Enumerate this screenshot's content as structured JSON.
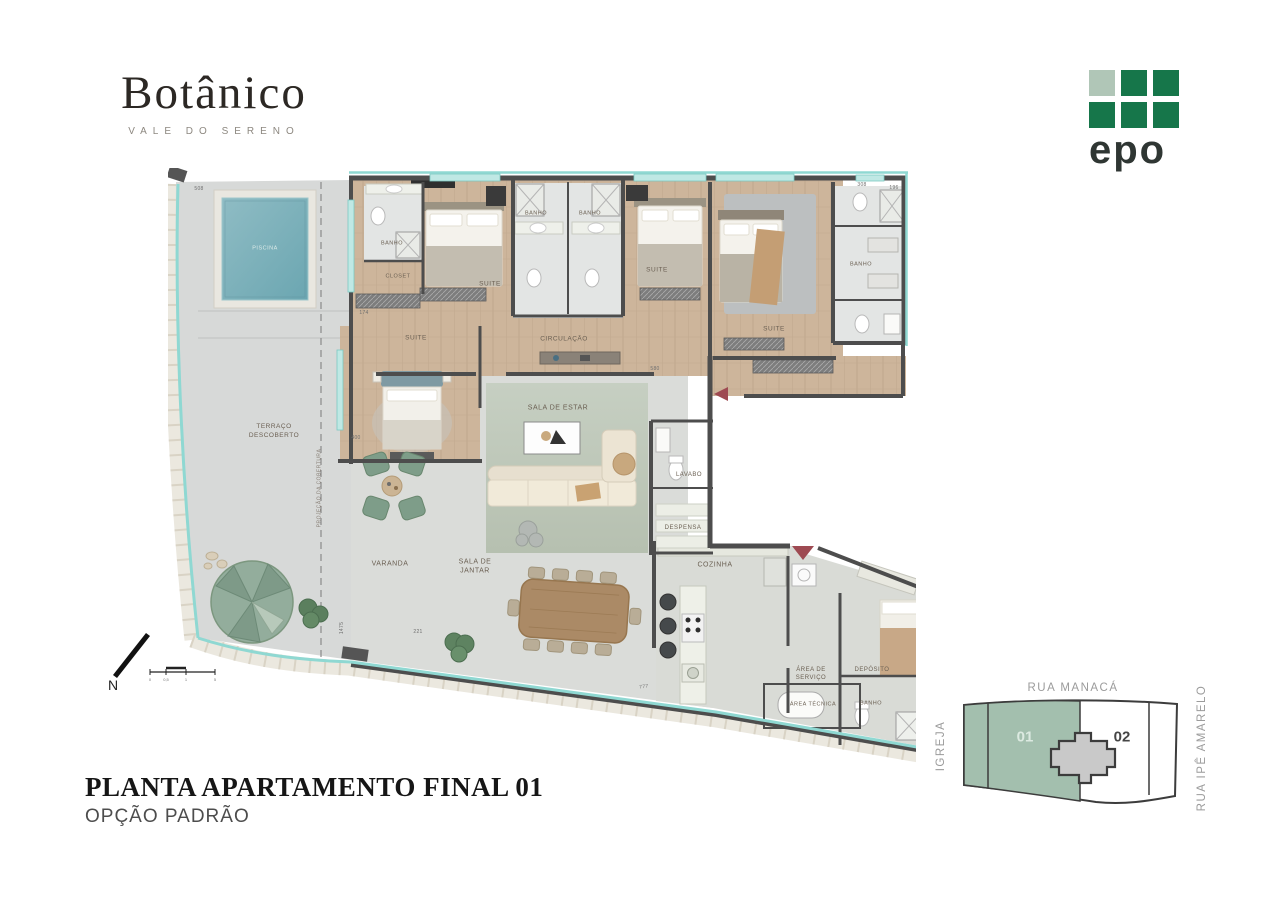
{
  "brand": {
    "name": "Botânico",
    "tagline": "VALE DO SERENO"
  },
  "developer": {
    "logo_text": "epo"
  },
  "plan_title": {
    "line1": "PLANTA APARTAMENTO FINAL 01",
    "line2": "OPÇÃO PADRÃO"
  },
  "compass": {
    "north": "N",
    "scale_ticks": [
      "0",
      "0,5",
      "1",
      "5"
    ]
  },
  "floor_plan": {
    "rooms": [
      {
        "id": "piscina",
        "label": "PISCINA",
        "x": 97,
        "y": 81,
        "size": 5.5,
        "color": "#dcebe9"
      },
      {
        "id": "terraco-descoberto",
        "label": "TERRAÇO\nDESCOBERTO",
        "x": 106,
        "y": 264,
        "size": 6.5
      },
      {
        "id": "projecao-cobertura",
        "label": "PROJEÇÃO DA COBERTURA",
        "x": 152,
        "y": 320,
        "size": 5,
        "rotate": -90,
        "color": "#8a8178"
      },
      {
        "id": "banho-suite-1",
        "label": "BANHO",
        "x": 224,
        "y": 76,
        "size": 5.5
      },
      {
        "id": "closet",
        "label": "CLOSET",
        "x": 230,
        "y": 109,
        "size": 5.5
      },
      {
        "id": "suite-1",
        "label": "SUITE",
        "x": 322,
        "y": 117,
        "size": 6.5
      },
      {
        "id": "suite-2",
        "label": "SUITE",
        "x": 248,
        "y": 171,
        "size": 6.5
      },
      {
        "id": "banho-suite-2",
        "label": "BANHO",
        "x": 368,
        "y": 46,
        "size": 5.5
      },
      {
        "id": "banho-suite-3",
        "label": "BANHO",
        "x": 422,
        "y": 46,
        "size": 5.5
      },
      {
        "id": "suite-3",
        "label": "SUITE",
        "x": 489,
        "y": 103,
        "size": 6.5
      },
      {
        "id": "suite-master",
        "label": "SUITE",
        "x": 606,
        "y": 162,
        "size": 6.5
      },
      {
        "id": "banho-master",
        "label": "BANHO",
        "x": 693,
        "y": 97,
        "size": 5.5
      },
      {
        "id": "circulacao",
        "label": "CIRCULAÇÃO",
        "x": 396,
        "y": 172,
        "size": 6.5
      },
      {
        "id": "sala-de-estar",
        "label": "SALA DE ESTAR",
        "x": 390,
        "y": 240,
        "size": 7
      },
      {
        "id": "lavabo",
        "label": "LAVABO",
        "x": 521,
        "y": 307,
        "size": 6
      },
      {
        "id": "despensa",
        "label": "DESPENSA",
        "x": 515,
        "y": 360,
        "size": 6
      },
      {
        "id": "cozinha",
        "label": "COZINHA",
        "x": 547,
        "y": 397,
        "size": 7
      },
      {
        "id": "varanda",
        "label": "VARANDA",
        "x": 222,
        "y": 396,
        "size": 7
      },
      {
        "id": "sala-de-jantar",
        "label": "SALA DE\nJANTAR",
        "x": 307,
        "y": 399,
        "size": 7
      },
      {
        "id": "area-de-servico",
        "label": "ÁREA DE\nSERVIÇO",
        "x": 643,
        "y": 506,
        "size": 6
      },
      {
        "id": "deposito",
        "label": "DEPÓSITO",
        "x": 704,
        "y": 502,
        "size": 6
      },
      {
        "id": "area-tecnica",
        "label": "ÁREA TÉCNICA",
        "x": 645,
        "y": 537,
        "size": 5.5
      },
      {
        "id": "banho-servico",
        "label": "BANHO",
        "x": 703,
        "y": 536,
        "size": 5.5
      }
    ],
    "dims": [
      {
        "t": "508",
        "x": 31,
        "y": 21
      },
      {
        "t": "308",
        "x": 694,
        "y": 17
      },
      {
        "t": "196",
        "x": 726,
        "y": 20
      },
      {
        "t": "174",
        "x": 196,
        "y": 145
      },
      {
        "t": "400",
        "x": 188,
        "y": 270
      },
      {
        "t": "1475",
        "x": 174,
        "y": 460,
        "rotate": -90
      },
      {
        "t": "221",
        "x": 250,
        "y": 464
      },
      {
        "t": "580",
        "x": 487,
        "y": 201
      },
      {
        "t": "777",
        "x": 476,
        "y": 519,
        "rotate": -8
      }
    ]
  },
  "site_map": {
    "street_top": "RUA MANACÁ",
    "street_left": "IGREJA",
    "street_right": "RUA IPÊ AMARELO",
    "unit_highlight": "01",
    "unit_other": "02"
  },
  "colors": {
    "accent_teal": "#8fd8d2",
    "wall": "#4d4d4d",
    "epo_green": "#16764a",
    "site_green": "#a3bfae",
    "arrow_red": "#9e4a52"
  }
}
